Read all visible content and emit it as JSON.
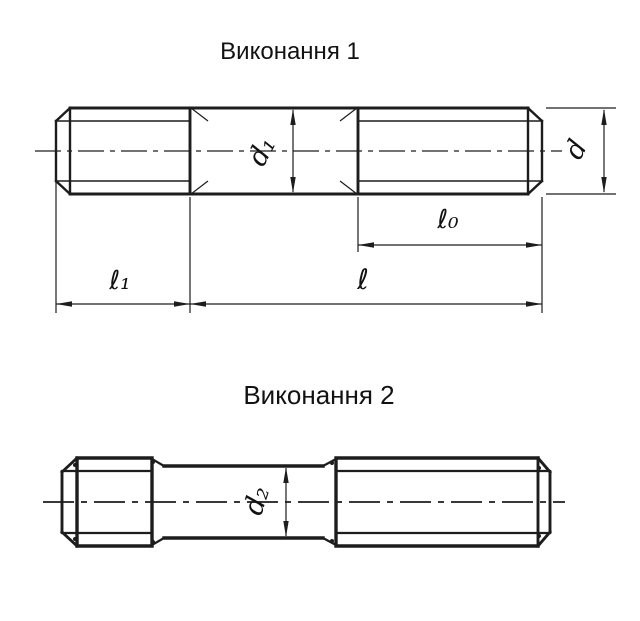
{
  "theme": {
    "background": "#ffffff",
    "line_color": "#1d1d1d",
    "text_color": "#121212"
  },
  "drawing_1": {
    "title": "Виконання 1",
    "labels": {
      "d1": "d₁",
      "d": "d",
      "l0": "ℓ₀",
      "l": "ℓ",
      "l1": "ℓ₁"
    }
  },
  "drawing_2": {
    "title": "Виконання 2",
    "labels": {
      "d2": "d₂"
    }
  }
}
